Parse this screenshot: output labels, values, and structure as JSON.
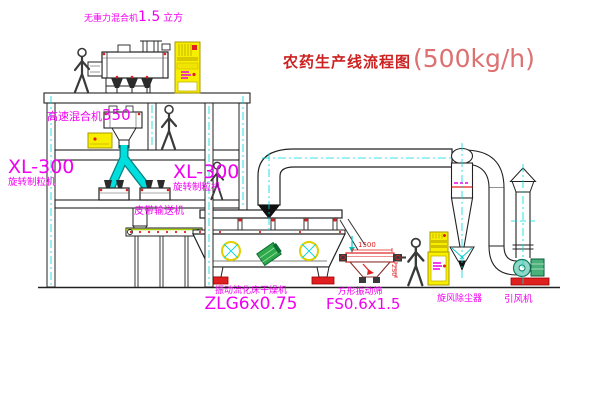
{
  "title": {
    "text": "农药生产线流程图",
    "capacity": "(500kg/h)"
  },
  "equipment": {
    "gravity_mixer": {
      "name": "无重力混合机",
      "capacity": "1.5",
      "unit": "立方"
    },
    "high_speed_mixer": {
      "name": "高速混合机",
      "model": "350"
    },
    "granulator_left": {
      "model": "XL-300",
      "name": "旋转制粒机"
    },
    "granulator_right": {
      "model": "XL-300",
      "name": "旋转制粒机"
    },
    "belt_conveyor": {
      "name": "皮带输送机"
    },
    "dryer": {
      "name": "振动流化床干燥机",
      "model": "ZLG6x0.75"
    },
    "sieve": {
      "name": "方形振动筛",
      "model": "FS0.6x1.5",
      "width_dim": "1500",
      "height_dim": "250"
    },
    "cyclone": {
      "name": "旋风除尘器"
    },
    "fan": {
      "name": "引风机"
    }
  },
  "colors": {
    "line": "#222222",
    "centerline": "#00d8d8",
    "pipe_cyan": "#00dede",
    "label_magenta": "#f000f0",
    "title_red": "#cc2222",
    "capacity_red": "#dd7070",
    "cabinet_yellow": "#f8ee00",
    "accent_red": "#e02020",
    "motor_green": "#2faa4a",
    "background": "#ffffff"
  }
}
